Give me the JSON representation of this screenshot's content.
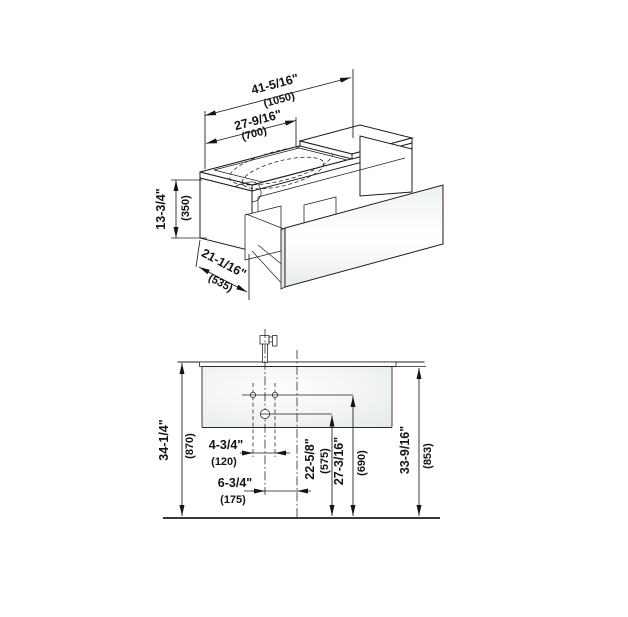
{
  "drawing": {
    "type": "technical-dimension-drawing",
    "subject": "wall-hung vanity unit with washbasin and drawer",
    "colors": {
      "line": "#1c1c1c",
      "panel_fill_light": "#fdfefe",
      "panel_fill_shade": "#e7ebec",
      "background": "#ffffff"
    }
  },
  "isometric": {
    "dim_total_width": {
      "in": "41-5/16\"",
      "mm": "(1050)"
    },
    "dim_basin_width": {
      "in": "27-9/16\"",
      "mm": "(700)"
    },
    "dim_body_height": {
      "in": "13-3/4\"",
      "mm": "(350)"
    },
    "dim_depth": {
      "in": "21-1/16\"",
      "mm": "(535)"
    }
  },
  "elevation": {
    "dim_height_floor_to_countertop": {
      "in": "34-1/4\"",
      "mm": "(870)"
    },
    "dim_height_floor_to_body_top": {
      "in": "33-9/16\"",
      "mm": "(853)"
    },
    "dim_tap_hole_spacing": {
      "in": "4-3/4\"",
      "mm": "(120)"
    },
    "dim_tap_center_offset": {
      "in": "6-3/4\"",
      "mm": "(175)"
    },
    "dim_drain_height": {
      "in": "22-5/8\"",
      "mm": "(575)"
    },
    "dim_holes_height": {
      "in": "27-3/16\"",
      "mm": "(690)"
    }
  }
}
